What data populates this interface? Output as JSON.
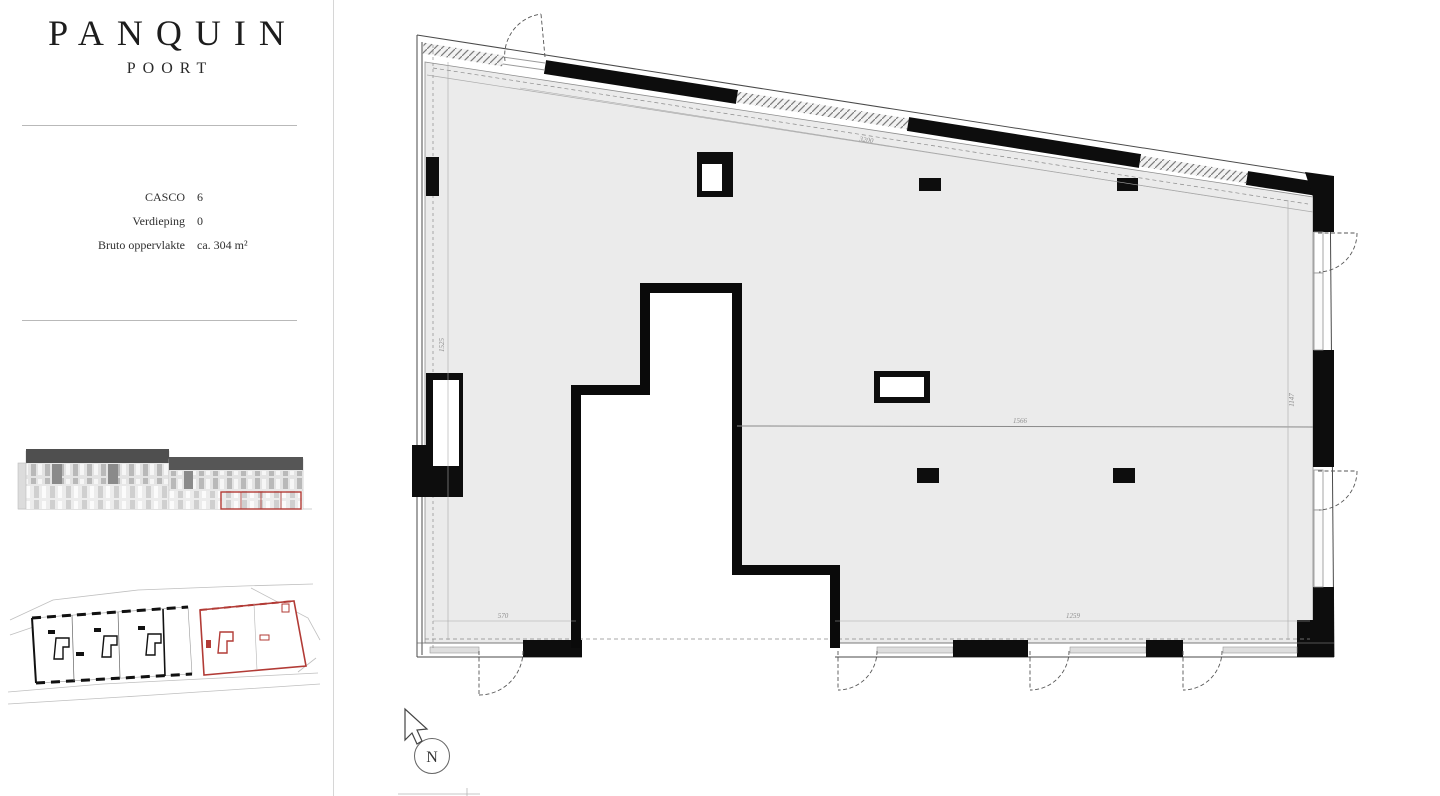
{
  "sidebar": {
    "brand": {
      "title": "PANQUIN",
      "subtitle": "POORT"
    },
    "info": {
      "rows": [
        {
          "label": "CASCO",
          "value": "6"
        },
        {
          "label": "Verdieping",
          "value": "0"
        },
        {
          "label": "Bruto oppervlakte",
          "value": "ca. 304 m²"
        }
      ]
    }
  },
  "plan": {
    "dimensions": {
      "top": "3200",
      "left": "1525",
      "right": "1147",
      "partition": "1566",
      "bottom_left": "570",
      "bottom_right": "1259"
    },
    "north_label": "N"
  },
  "colors": {
    "accent_red": "#b23b36",
    "wall_black": "#111111",
    "floor_gray": "#ebebeb"
  }
}
